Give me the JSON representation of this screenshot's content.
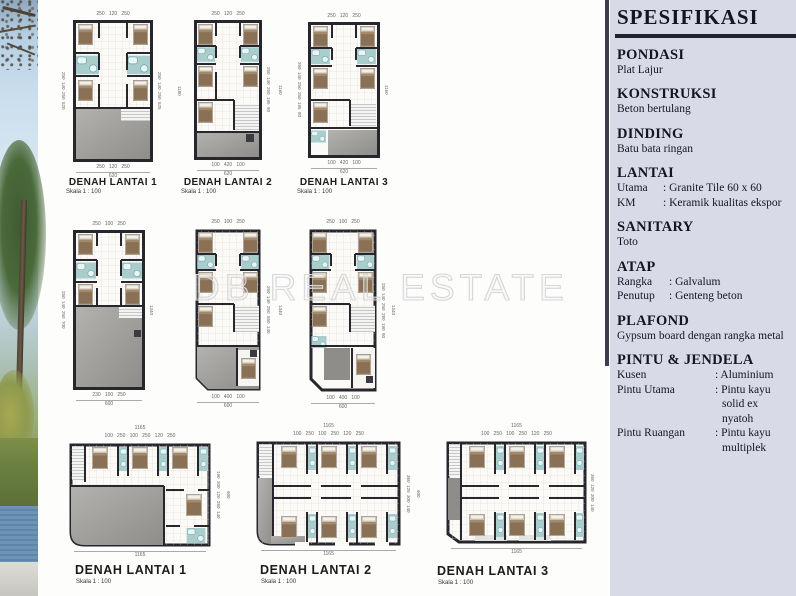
{
  "watermark": "DB REAL ESTATE",
  "specs": {
    "title": "SPESIFIKASI",
    "sections": [
      {
        "heading": "PONDASI",
        "rows": [
          {
            "key": "",
            "value": "Plat Lajur",
            "value2": ""
          }
        ]
      },
      {
        "heading": "KONSTRUKSI",
        "rows": [
          {
            "key": "",
            "value": "Beton bertulang",
            "value2": ""
          }
        ]
      },
      {
        "heading": "DINDING",
        "rows": [
          {
            "key": "",
            "value": "Batu bata ringan",
            "value2": ""
          }
        ]
      },
      {
        "heading": "LANTAI",
        "rows": [
          {
            "key": "Utama",
            "value": ": Granite Tile 60 x 60",
            "value2": ""
          },
          {
            "key": "KM",
            "value": ": Keramik kualitas ekspor",
            "value2": ""
          }
        ]
      },
      {
        "heading": "SANITARY",
        "rows": [
          {
            "key": "",
            "value": "Toto",
            "value2": ""
          }
        ]
      },
      {
        "heading": "ATAP",
        "rows": [
          {
            "key": "Rangka",
            "value": ": Galvalum",
            "value2": ""
          },
          {
            "key": "Penutup",
            "value": ": Genteng beton",
            "value2": ""
          }
        ]
      },
      {
        "heading": "PLAFOND",
        "rows": [
          {
            "key": "",
            "value": "Gypsum board dengan rangka metal",
            "value2": ""
          }
        ]
      },
      {
        "heading": "PINTU & JENDELA",
        "rows": [
          {
            "key": "Kusen",
            "value": ": Aluminium",
            "value2": ""
          },
          {
            "key": "Pintu Utama",
            "value": ": Pintu kayu",
            "value2": "solid ex nyatoh"
          },
          {
            "key": "Pintu Ruangan",
            "value": ": Pintu kayu",
            "value2": "multiplek"
          }
        ]
      }
    ]
  },
  "colors": {
    "panel": "#d9dae8",
    "wall": "#26262c",
    "concrete": "#a3a19d",
    "bath": "#a9cdcd",
    "bed": "#8a7156"
  },
  "plans": {
    "row1": [
      {
        "label": "DENAH LANTAI 1",
        "scale": "Skala 1 : 100",
        "top": "250   120   250",
        "bottom": "250   120   250",
        "total": "620",
        "left": "250  140  250  520",
        "right": "250  140  250  525",
        "side": "1180"
      },
      {
        "label": "DENAH LANTAI 2",
        "scale": "Skala 1 : 100",
        "top": "250   120   250",
        "bottom": "100   420   100",
        "total": "620",
        "right": "250  140  250  195  80",
        "side": "1160"
      },
      {
        "label": "DENAH LANTAI 3",
        "scale": "Skala 1 : 100",
        "top": "250   120   250",
        "bottom": "100   420   100",
        "total": "620",
        "left": "250  140  250  250  195  80",
        "side": "1160"
      }
    ],
    "row2": [
      {
        "top": "250   100   250",
        "bottom": "230   100   250",
        "total": "600",
        "left": "250  140  250  700",
        "side": "1340"
      },
      {
        "top": "250   100   250",
        "bottom": "100   400   100",
        "total": "600",
        "right": "250  140  250  550  140",
        "side": "1340"
      },
      {
        "top": "250   100   250",
        "bottom": "100   400   100",
        "total": "600",
        "right": "250  140  250  280  190  80",
        "side": "1340"
      }
    ],
    "row3": [
      {
        "label": "DENAH LANTAI 1",
        "scale": "Skala 1 : 100",
        "top_total": "1165",
        "top": "100   250   100   250   120   250",
        "bottom": "1165",
        "right": "190  300  120  250  140",
        "side": "900"
      },
      {
        "label": "DENAH LANTAI 2",
        "scale": "Skala 1 : 100",
        "top_total": "1165",
        "top": "100   250   100   250   120   250",
        "bottom": "1165",
        "right": "360  120  300  140",
        "side": "900"
      },
      {
        "label": "DENAH LANTAI 3",
        "scale": "Skala 1 : 100",
        "top_total": "1165",
        "top": "100   250   100   250   120   250",
        "bottom": "1165",
        "right": "360  120  300  140",
        "side": "900"
      }
    ]
  }
}
